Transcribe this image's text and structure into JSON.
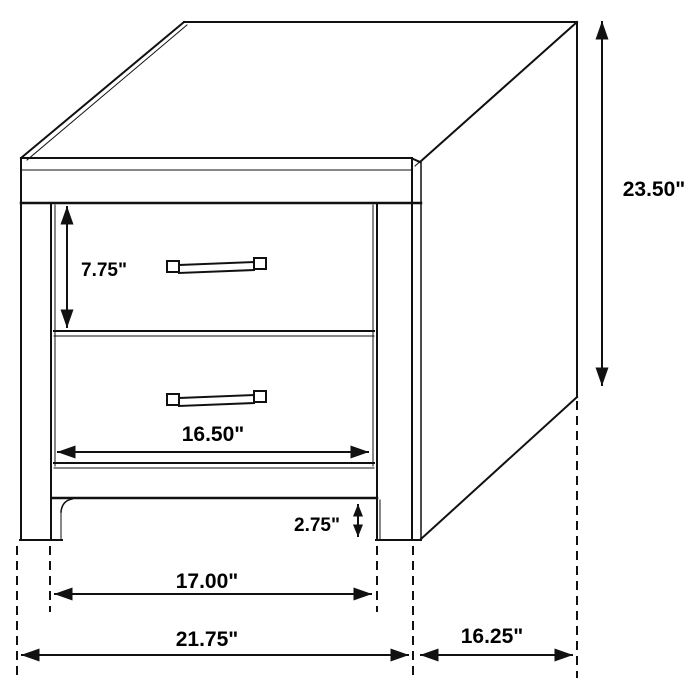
{
  "figure": {
    "description": "Black-and-white line drawing of a two-drawer nightstand shown in perspective with dimension arrows",
    "background_color": "#ffffff",
    "line_color": "#111111",
    "unit": "inches",
    "dimensions": {
      "drawer_front_height": "7.75\"",
      "overall_height": "23.50\"",
      "drawer_width": "16.50\"",
      "base_clearance": "2.75\"",
      "leg_spacing": "17.00\"",
      "overall_width": "21.75\"",
      "overall_depth": "16.25\""
    }
  }
}
